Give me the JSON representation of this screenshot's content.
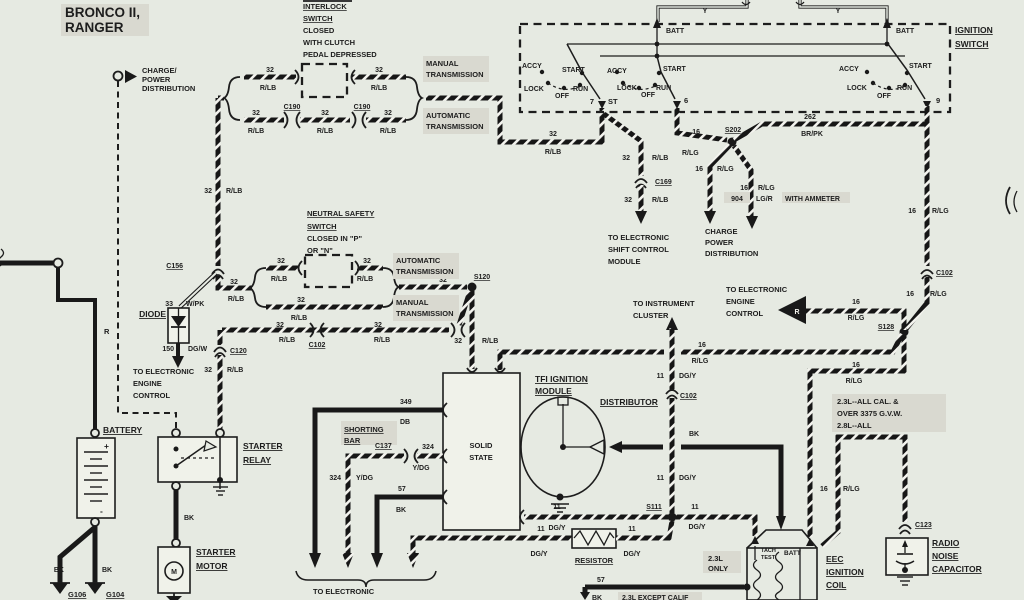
{
  "page": {
    "bg": "#e6eae2",
    "ink": "#1d1d1d",
    "highlight": "#d9d9d0",
    "wire_white_dash": "#f4f4ef"
  },
  "title": {
    "line1": "BRONCO II,",
    "line2": "RANGER"
  },
  "w": {
    "g32": "32",
    "rlb": "R/LB",
    "g16": "16",
    "rlg": "R/LG",
    "g11": "11",
    "dgy": "DG/Y",
    "g57": "57",
    "bk": "BK",
    "g349": "349",
    "db": "DB",
    "g324": "324",
    "ydg": "Y/DG",
    "g262": "262",
    "brpk": "BR/PK",
    "g904": "904",
    "lgr": "LG/R",
    "g150": "150",
    "dgw": "DG/W",
    "g33": "33",
    "wpk": "W/PK",
    "r": "R",
    "y": "Y"
  },
  "conn": {
    "c190": "C190",
    "c156": "C156",
    "c120": "C120",
    "c102": "C102",
    "c169": "C169",
    "c137": "C137",
    "c123": "C123",
    "s120": "S120",
    "s202": "S202",
    "s111": "S111",
    "s128": "S128",
    "g106": "G106",
    "g104": "G104"
  },
  "charge_power": {
    "l1": "CHARGE/",
    "l2": "POWER",
    "l3": "DISTRIBUTION"
  },
  "interlock": {
    "l1": "INTERLOCK",
    "l2": "SWITCH",
    "l3": "CLOSED",
    "l4": "WITH CLUTCH",
    "l5": "PEDAL DEPRESSED"
  },
  "trans": {
    "manual": "MANUAL",
    "auto": "AUTOMATIC",
    "transmission": "TRANSMISSION"
  },
  "ign": {
    "title1": "IGNITION",
    "title2": "SWITCH",
    "batt": "BATT",
    "accy": "ACCY",
    "start": "START",
    "lock": "LOCK",
    "off": "OFF",
    "run": "RUN",
    "t7": "7",
    "st": "ST",
    "t6": "6",
    "t9": "9"
  },
  "ns": {
    "l1": "NEUTRAL SAFETY",
    "l2": "SWITCH",
    "l3": "CLOSED IN \"P\"",
    "l4": "OR \"N\""
  },
  "diode": {
    "label": "DIODE",
    "d1": "TO ELECTRONIC",
    "d2": "ENGINE",
    "d3": "CONTROL"
  },
  "shift": {
    "l1": "TO ELECTRONIC",
    "l2": "SHIFT CONTROL",
    "l3": "MODULE"
  },
  "cpd2": {
    "l1": "CHARGE",
    "l2": "POWER",
    "l3": "DISTRIBUTION",
    "ammeter": "WITH AMMETER"
  },
  "battery": {
    "label": "BATTERY",
    "plus": "+",
    "minus": "-"
  },
  "relay": {
    "l1": "STARTER",
    "l2": "RELAY"
  },
  "motor": {
    "l1": "STARTER",
    "l2": "MOTOR",
    "m": "M"
  },
  "tfi": {
    "l1": "TFI IGNITION",
    "l2": "MODULE",
    "solid": "SOLID",
    "state": "STATE",
    "dist": "DISTRIBUTOR"
  },
  "sbar": {
    "l1": "SHORTING",
    "l2": "BAR"
  },
  "eca": {
    "l1": "TO ELECTRONIC",
    "l2": "CONTROL ASSEMBLY"
  },
  "instr": {
    "l1": "TO INSTRUMENT",
    "l2": "CLUSTER"
  },
  "eec": {
    "r": "R",
    "l1": "TO ELECTRONIC",
    "l2": "ENGINE",
    "l3": "CONTROL"
  },
  "res": {
    "label": "RESISTOR"
  },
  "coil": {
    "l1": "EEC",
    "l2": "IGNITION",
    "l3": "COIL",
    "tach": "TACH",
    "test": "TEST",
    "batt": "BATT"
  },
  "cap": {
    "l1": "RADIO",
    "l2": "NOISE",
    "l3": "CAPACITOR"
  },
  "notes": {
    "cal1": "2.3L--ALL CAL. &",
    "cal2": "OVER 3375 G.V.W.",
    "cal3": "2.8L--ALL",
    "only1": "2.3L",
    "only2": "ONLY",
    "except": "2.3L EXCEPT CALIF"
  }
}
